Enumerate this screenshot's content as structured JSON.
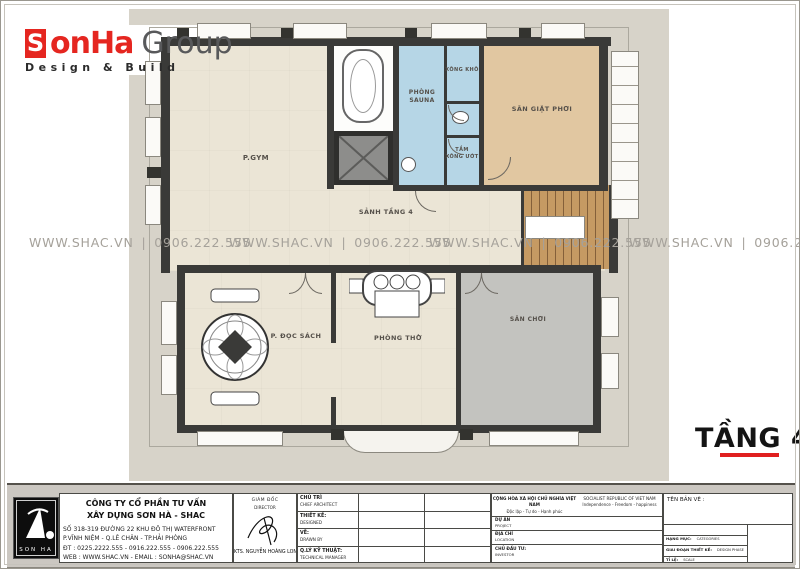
{
  "brand": {
    "initial": "S",
    "rest": "onHa",
    "group": "Group",
    "tagline": "Design & Build"
  },
  "watermark": "WWW.SHAC.VN | 0906.222.555",
  "plan": {
    "floor_title": "TẦNG 4",
    "rooms": {
      "gym": "P.GYM",
      "sauna": "PHÒNG SAUNA",
      "dry_sauna": "XÔNG KHÔ",
      "wet_steam_line1": "TẮM",
      "wet_steam_line2": "XÔNG ƯỚT",
      "laundry": "SÂN GIẶT PHƠI",
      "hall": "SẢNH TẦNG 4",
      "reading": "P. ĐỌC SÁCH",
      "worship": "PHÒNG THỜ",
      "play": "SÂN CHƠI"
    }
  },
  "title_block": {
    "logo_text": "SON HA",
    "company_line1": "CÔNG TY CỔ PHẦN TƯ VẤN",
    "company_line2": "XÂY DỰNG SƠN HÀ - SHAC",
    "address_line1": "SỐ 318-319 ĐƯỜNG 22 KHU ĐÔ THỊ WATERFRONT",
    "address_line2": "P.VĨNH NIỆM - Q.LÊ CHÂN - TP.HẢI PHÒNG",
    "phone_line": "ĐT : 0225.2222.555 - 0916.222.555 - 0906.222.555",
    "web_line": "WEB : WWW.SHAC.VN - EMAIL : SONHA@SHAC.VN",
    "director_vi": "GIÁM ĐỐC",
    "director_en": "DIRECTOR",
    "director_name": "KTS. NGUYỄN HOÀNG LONG",
    "rows": [
      {
        "vi": "CHỦ TRÌ",
        "en": "CHIEF ARCHITECT"
      },
      {
        "vi": "THIẾT KẾ:",
        "en": "DESIGNED"
      },
      {
        "vi": "VẼ:",
        "en": "DRAWN BY"
      },
      {
        "vi": "Q.LÝ KỸ THUẬT:",
        "en": "TECHNICAL MANAGER"
      }
    ],
    "republic_vi1": "CỘNG HÒA XÃ HỘI CHỦ NGHĨA VIỆT NAM",
    "republic_vi2": "Độc lập - Tự do - Hạnh phúc",
    "republic_en1": "SOCIALIST REPUBLIC OF VIET NAM",
    "republic_en2": "Independence - Freedom - happiness",
    "project_vi": "DỰ ÁN",
    "project_en": "PROJECT",
    "location_vi": "ĐỊA CHỈ",
    "location_en": "LOCATION",
    "investor_vi": "CHỦ ĐẦU TƯ:",
    "investor_en": "INVESTOR",
    "drawing_name_label": "TÊN BẢN VẼ :",
    "meta_rows": [
      {
        "vi": "HẠNG MỤC:",
        "en": "CATEGORIES"
      },
      {
        "vi": "GIAI ĐOẠN THIẾT KẾ:",
        "en": "DESIGN PHASE"
      },
      {
        "vi": "TỈ LỆ:",
        "en": "SCALE"
      },
      {
        "vi": "HOÀN THÀNH:",
        "en": "DATE"
      }
    ]
  },
  "colors": {
    "accent_red": "#e01f1f",
    "brand_red": "#e52620",
    "sauna_blue": "#b6d6e6",
    "laundry_tan": "#e1c7a1",
    "play_gray": "#c3c3bf",
    "room_cream": "#ebe5d6",
    "wall_dark": "#3a3a38",
    "stair_wood": "#c59a63",
    "sheet_gray": "#d7d3c9",
    "watermark_gray": "#a5a19a"
  }
}
